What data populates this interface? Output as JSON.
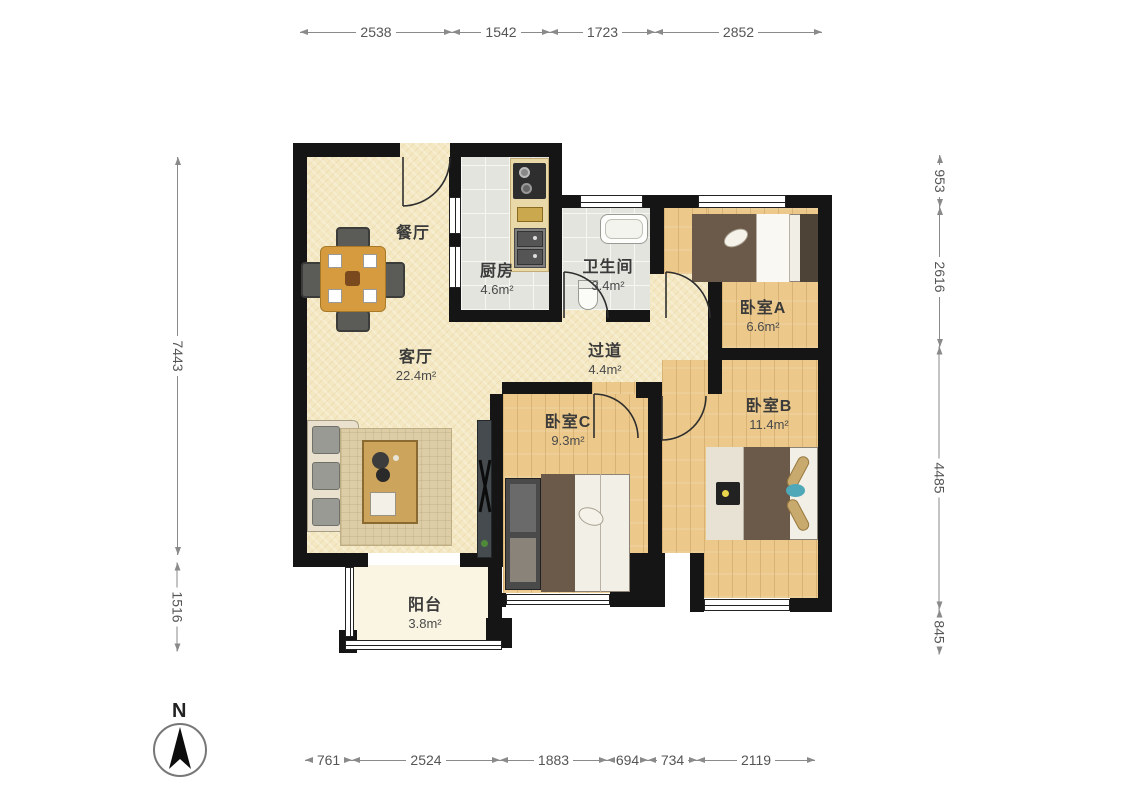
{
  "title": "apartment-floor-plan",
  "compass": {
    "label": "N"
  },
  "rooms": {
    "dining": {
      "name": "餐厅",
      "area": ""
    },
    "kitchen": {
      "name": "厨房",
      "area": "4.6m²"
    },
    "bathroom": {
      "name": "卫生间",
      "area": "3.4m²"
    },
    "bedroomA": {
      "name": "卧室A",
      "area": "6.6m²"
    },
    "living": {
      "name": "客厅",
      "area": "22.4m²"
    },
    "hallway": {
      "name": "过道",
      "area": "4.4m²"
    },
    "bedroomC": {
      "name": "卧室C",
      "area": "9.3m²"
    },
    "bedroomB": {
      "name": "卧室B",
      "area": "11.4m²"
    },
    "balcony": {
      "name": "阳台",
      "area": "3.8m²"
    }
  },
  "dimensions": {
    "top": [
      "2538",
      "1542",
      "1723",
      "2852"
    ],
    "bottom": [
      "761",
      "2524",
      "1883",
      "694",
      "734",
      "2119"
    ],
    "left": [
      "7443",
      "1516"
    ],
    "right": [
      "953",
      "2616",
      "4485",
      "845"
    ]
  },
  "colors": {
    "wall": "#151515",
    "floor_living": "#f4e8c3",
    "floor_bedroom": "#ecc98b",
    "floor_tile": "#e4e4df",
    "floor_balcony": "#f9f5e2",
    "dimension_text": "#555555"
  }
}
